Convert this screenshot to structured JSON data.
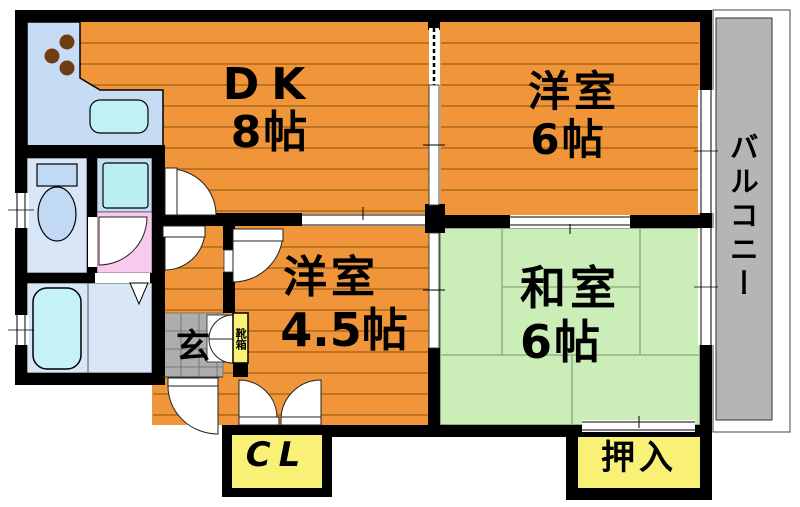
{
  "floorplan": {
    "rooms": {
      "dk": {
        "name": "DK",
        "size": "8帖"
      },
      "western6": {
        "name": "洋室",
        "size": "6帖"
      },
      "western45": {
        "name": "洋室",
        "size": "4.5帖"
      },
      "japanese6": {
        "name": "和室",
        "size": "6帖"
      },
      "balcony": {
        "name": "バルコニー"
      },
      "entrance": {
        "name": "玄"
      },
      "shoe_cabinet": {
        "name": "靴箱"
      },
      "closet": {
        "name": "CL"
      },
      "oshiire": {
        "name": "押入"
      }
    },
    "colors": {
      "wood_floor_orange": "#F09539",
      "plank_line": "#9C5F14",
      "tatami_green": "#CBEDB7",
      "tatami_line": "#85A878",
      "closet_yellow": "#F8F176",
      "balcony_gray": "#B5B5B5",
      "entrance_tile_gray": "#ADADAD",
      "counter_blue": "#C6DBF4",
      "water_cyan": "#BFF1F5",
      "sanitary_floor_blue": "#D9E6F8",
      "washroom_pink": "#F8CAEE",
      "burner_brown": "#6F3D12",
      "wall_black": "#000000"
    }
  }
}
